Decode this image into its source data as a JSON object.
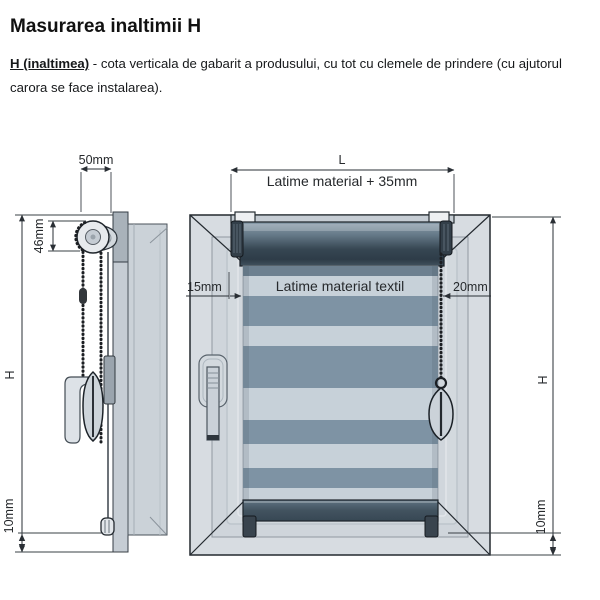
{
  "header": {
    "title": "Masurarea inaltimii H"
  },
  "description": {
    "lead": "H (inaltimea)",
    "body": " - cota verticala de gabarit a produsului, cu tot cu clemele de prindere (cu ajutorul carora se face instalarea)."
  },
  "side_view": {
    "dim_width_top": "50mm",
    "dim_cassette": "46mm",
    "dim_height": "H",
    "dim_bottom_gap": "10mm"
  },
  "front_view": {
    "dim_total_width": "L",
    "dim_total_width_note": "Latime material + 35mm",
    "dim_left_gap": "15mm",
    "fabric_width_label": "Latime material textil",
    "dim_right_gap": "20mm",
    "dim_height": "H",
    "dim_bottom_gap": "10mm"
  },
  "colors": {
    "line": "#23292f",
    "dimension": "#2a2f35",
    "frame_fill": "#d7dce1",
    "sash_fill": "#cfd5db",
    "fabric_dark": "#7e93a4",
    "fabric_light": "#c7d1d9",
    "tube_dark": "#33434f",
    "bottom_bar_dark": "#3a4a57"
  }
}
